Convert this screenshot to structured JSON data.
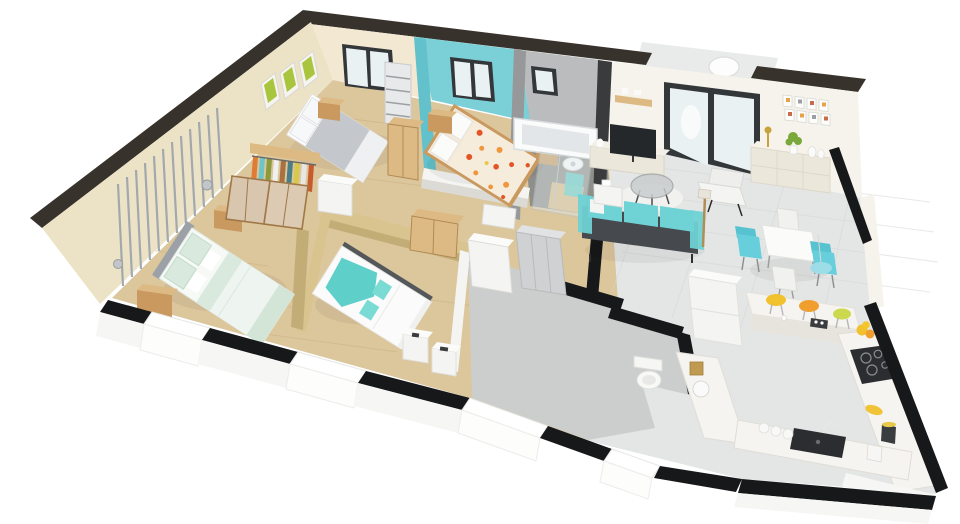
{
  "meta": {
    "content_type": "3d-floorplan-render",
    "view": "isometric cutaway dollhouse view of a single-storey house, white background, no visible text"
  },
  "palette": {
    "page_bg": "#ffffff",
    "roof_band": "#38322c",
    "cut_wall_black": "#17181a",
    "exterior_white": "#f6f6f4",
    "wall_beige": "#ece3c6",
    "wall_beige_light": "#f3e8d2",
    "wall_tan": "#d9c48f",
    "wall_tan_dark": "#c3ad77",
    "wall_teal": "#7bd0d8",
    "wall_teal_dark": "#63c1cb",
    "wall_gray": "#97989a",
    "wall_gray_light": "#bbbcbd",
    "wall_cream": "#f6f3ec",
    "floor_wood": "#dcc69c",
    "floor_wood_dark": "#c8ad7d",
    "floor_tile_light": "#e4e6e5",
    "floor_tile_gray": "#cbcecd",
    "floor_tile_dark": "#87898a",
    "window_frame": "#34373a",
    "glass": "#e9f1f2",
    "furniture_white": "#f4f4f2",
    "furniture_cream": "#ece7db",
    "wood_light": "#ddba84",
    "wood_mid": "#c9995f",
    "sofa_teal": "#6fd2d4",
    "sofa_frame": "#46494d",
    "chair_teal": "#66cfdb",
    "bed_gray": "#c4c7cb",
    "bed_mint": "#d9e9de",
    "bed_teal": "#5ecfc9",
    "floral_base": "#f4e9d8",
    "floral_red": "#e25527",
    "floral_orange": "#f0963c",
    "tv_dark": "#25282a",
    "counter_white": "#f6f4f0",
    "counter_face": "#e7e4dd",
    "appliance_dark": "#2b2d30",
    "stool_yellow": "#f2c12e",
    "stool_orange": "#f09f2e",
    "stool_green": "#ccd84e",
    "accent_gold": "#c8a23a",
    "plant_green": "#7aa83c",
    "art_green": "#a9c53e",
    "stripe_gray": "#9aa2aa",
    "pendant_blue": "#9fdde8"
  },
  "scene": {
    "rooms": [
      {
        "id": "bedroom-back-left",
        "walls": "beige",
        "floor": "wood",
        "items": [
          "double-bed-gray-white",
          "wood-nightstand",
          "bookshelf",
          "wood-wardrobe",
          "window",
          "green-wall-art-x3"
        ]
      },
      {
        "id": "bedroom-turquoise",
        "walls": "turquoise",
        "floor": "wood",
        "items": [
          "double-bed-orange-floral",
          "wood-nightstand-left",
          "wood-nightstand-right",
          "window"
        ]
      },
      {
        "id": "bathroom",
        "walls": "gray",
        "floor": "dark-gray-tile",
        "items": [
          "bathtub",
          "walk-in-shower-glass",
          "teal-towel",
          "wood-bench",
          "round-white-object",
          "window"
        ]
      },
      {
        "id": "bedroom-front-left",
        "walls": "beige-with-striped-panel",
        "floor": "wood",
        "items": [
          "double-bed-white-mint",
          "wood-nightstand-x2",
          "wall-sconce-x2"
        ]
      },
      {
        "id": "dressing",
        "walls": "beige",
        "floor": "wood",
        "items": [
          "open-wardrobe-with-clothes",
          "sliding-door-panels-x2",
          "white-cabinet"
        ]
      },
      {
        "id": "bedroom-center",
        "walls": "tan",
        "floor": "wood",
        "items": [
          "double-bed-white-teal",
          "white-nightstand-x2",
          "wood-cabinet-in-hall"
        ]
      },
      {
        "id": "hallway",
        "walls": "mixed",
        "floor": "wood-and-gray-tile",
        "items": [
          "tall-white-cabinet",
          "gray-storage-unit",
          "white-door-panel"
        ]
      },
      {
        "id": "wc",
        "walls": "black-cut",
        "floor": "gray-tile",
        "items": [
          "toilet"
        ]
      },
      {
        "id": "living-room",
        "walls": "off-white",
        "floor": "light-gray-tile",
        "items": [
          "sliding-glass-door",
          "terrace-hanging-chair",
          "wall-shelf",
          "tv",
          "tv-stand",
          "gallery-wall-8-frames",
          "sideboard",
          "candlestick-lamp",
          "plant",
          "white-vases-x2",
          "round-glass-coffee-table",
          "white-rug",
          "teal-sofa",
          "white-lounge-chair",
          "floor-lamp",
          "white-end-table"
        ]
      },
      {
        "id": "dining-area",
        "floor": "light-gray-tile",
        "items": [
          "square-white-table",
          "teal-chair-x2",
          "white-chair-x2",
          "blue-pendant-light"
        ]
      },
      {
        "id": "kitchen",
        "walls": "white",
        "floor": "light-gray-tile",
        "items": [
          "u-shaped-white-counter",
          "breakfast-bar",
          "bar-stool-yellow",
          "bar-stool-orange",
          "bar-stool-green",
          "espresso-set",
          "black-cooktop",
          "black-sink",
          "tall-fridge-cabinet",
          "kettle",
          "coffee-maker",
          "white-jars-x3",
          "fruit-bowl",
          "bananas",
          "dark-jar"
        ]
      }
    ],
    "exterior": [
      "dark-wall-top-bands",
      "black-cut-front-walls",
      "white-window-bays",
      "terrace-opening"
    ]
  }
}
